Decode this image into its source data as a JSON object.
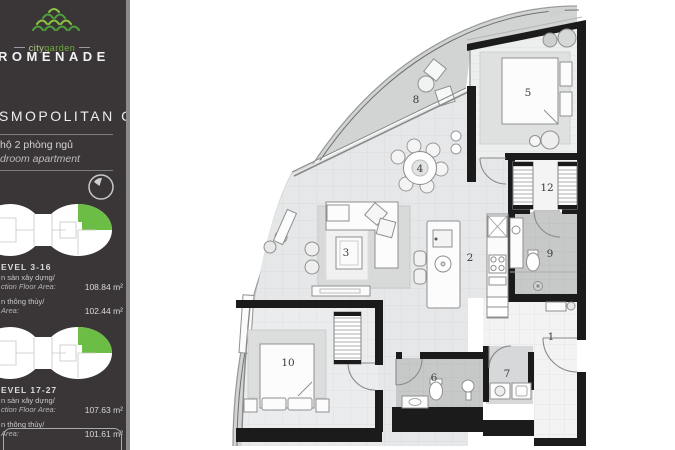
{
  "colors": {
    "sidebar_bg": "#3a3637",
    "accent_green": "#6cbd45",
    "wall": "#1b1b1b",
    "balcony": "#d2d4d3"
  },
  "sidebar": {
    "brand": {
      "city": "city",
      "garden": "garden",
      "name": "ROMENADE"
    },
    "unit_title": "SMOPOLITAN C",
    "subtitle_vi": "hộ 2 phòng ngủ",
    "subtitle_en": "droom apartment",
    "levels": [
      {
        "label": "EVEL 3-16",
        "rows": [
          {
            "vi": "n sàn xây dựng/",
            "en": "ction Floor Area:",
            "value": "108.84 m²"
          },
          {
            "vi": "n thông thủy/",
            "en": "Area:",
            "value": "102.44 m²"
          }
        ]
      },
      {
        "label": "EVEL 17-27",
        "rows": [
          {
            "vi": "n sàn xây dựng/",
            "en": "ction Floor Area:",
            "value": "107.63 m²"
          },
          {
            "vi": "n thông thủy/",
            "en": "Area:",
            "value": "101.61 m²"
          }
        ]
      }
    ]
  },
  "floorplan": {
    "labels": [
      {
        "text": "1",
        "x": 421,
        "y": 340
      },
      {
        "text": "2",
        "x": 340,
        "y": 261
      },
      {
        "text": "3",
        "x": 216,
        "y": 256
      },
      {
        "text": "4",
        "x": 290,
        "y": 172
      },
      {
        "text": "5",
        "x": 398,
        "y": 96
      },
      {
        "text": "6",
        "x": 304,
        "y": 381
      },
      {
        "text": "7",
        "x": 377,
        "y": 377
      },
      {
        "text": "8",
        "x": 286,
        "y": 103
      },
      {
        "text": "9",
        "x": 420,
        "y": 257
      },
      {
        "text": "10",
        "x": 158,
        "y": 366
      },
      {
        "text": "12",
        "x": 417,
        "y": 191
      }
    ]
  }
}
